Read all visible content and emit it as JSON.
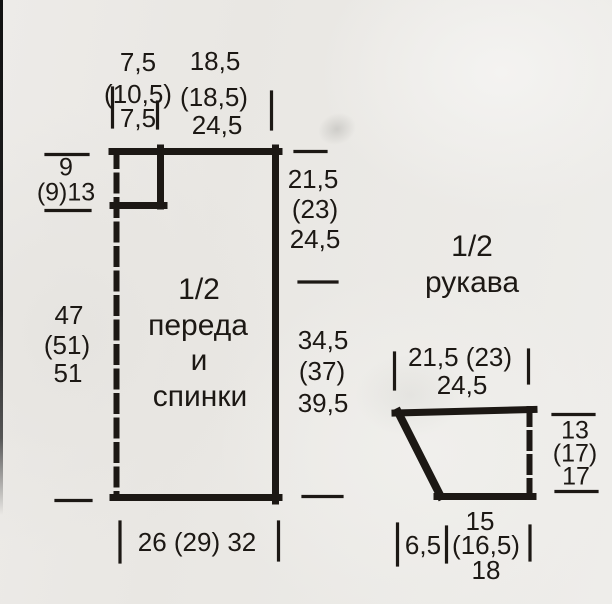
{
  "colors": {
    "ink": "#1c1814",
    "paper": "#e9e7e3"
  },
  "front_back": {
    "title": [
      "1/2",
      "переда",
      "и",
      "спинки"
    ],
    "neck_width": [
      "7,5",
      "(10,5)",
      "7,5"
    ],
    "shoulder_width": [
      "18,5",
      "(18,5)",
      "24,5"
    ],
    "neck_depth": [
      "9",
      "(9)13"
    ],
    "total_length": [
      "47",
      "(51)",
      "51"
    ],
    "armhole_depth": [
      "21,5",
      "(23)",
      "24,5"
    ],
    "side_length": [
      "34,5",
      "(37)",
      "39,5"
    ],
    "bottom_width": "26 (29) 32"
  },
  "sleeve": {
    "title": [
      "1/2",
      "рукава"
    ],
    "top_width": [
      "21,5 (23)",
      "24,5"
    ],
    "cap_height": [
      "13",
      "(17)",
      "17"
    ],
    "slant_width": "6,5",
    "bottom_width": [
      "15",
      "(16,5)",
      "18"
    ]
  }
}
